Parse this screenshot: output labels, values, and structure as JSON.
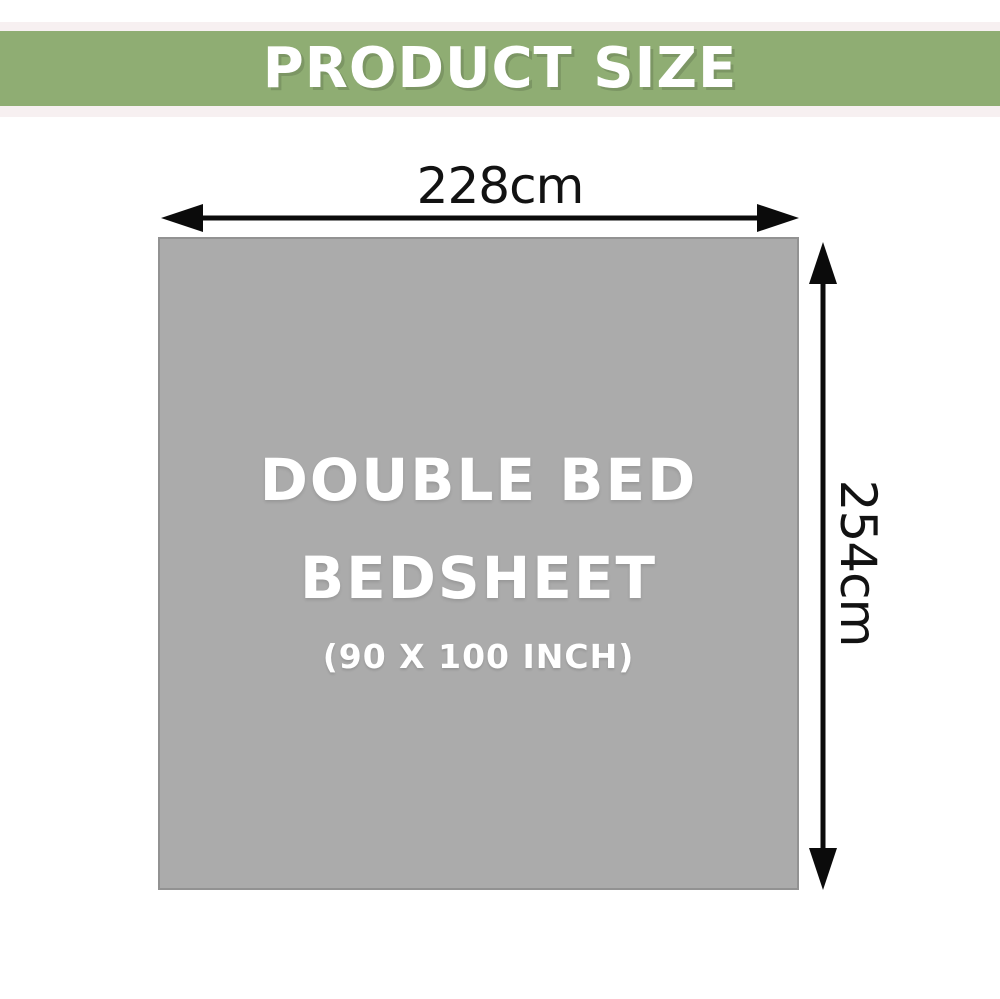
{
  "header": {
    "title": "PRODUCT SIZE"
  },
  "diagram": {
    "product": {
      "line1": "DOUBLE BED",
      "line2": "BEDSHEET",
      "line3": "(90 X 100 INCH)"
    },
    "width_label": "228cm",
    "height_label": "254cm"
  },
  "icons": {
    "width_arrow": "double-headed-horizontal-arrow",
    "height_arrow": "double-headed-vertical-arrow"
  },
  "colors": {
    "banner_green": "#8FAD73",
    "banner_border_pink": "#F7F0F1",
    "sheet_gray": "#ABABAB",
    "sheet_border_gray": "#929292",
    "arrow_black": "#0B0B0B",
    "label_black": "#121212",
    "text_white": "#FFFFFF"
  }
}
